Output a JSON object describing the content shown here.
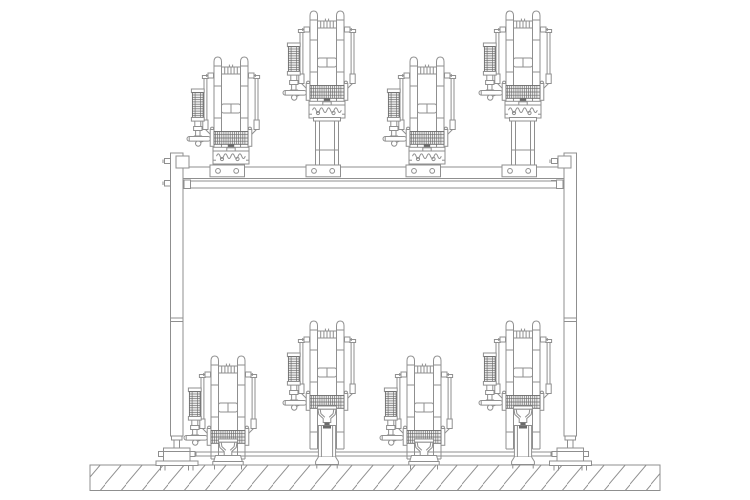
{
  "meta": {
    "title": "Technical side-elevation drawing: gantry frame fixture with four clamp units on the top beam and four clamp units standing on the floor",
    "background": "#ffffff"
  },
  "canvas": {
    "width": 750,
    "height": 500
  },
  "drawing": {
    "stroke": "#8f8f8f",
    "stroke_dark": "#6b6b6b",
    "fill": "#ffffff",
    "knurl_fill": "#ededed",
    "hatch_spacing": 21
  },
  "stations": {
    "top": [
      {
        "type": "short",
        "x": 231,
        "y": 56
      },
      {
        "type": "tall",
        "x": 327,
        "y": 10
      },
      {
        "type": "short",
        "x": 427,
        "y": 56
      },
      {
        "type": "tall",
        "x": 523,
        "y": 10
      }
    ],
    "bottom": [
      {
        "type": "short",
        "x": 228,
        "y": 355
      },
      {
        "type": "tall",
        "x": 327,
        "y": 320
      },
      {
        "type": "short",
        "x": 424,
        "y": 355
      },
      {
        "type": "tall",
        "x": 523,
        "y": 320
      }
    ]
  },
  "frame": {
    "post_top_y": 153,
    "beam_y": 167,
    "rail_y": 181,
    "tie_rod_y": 452,
    "ground_y": 465
  }
}
